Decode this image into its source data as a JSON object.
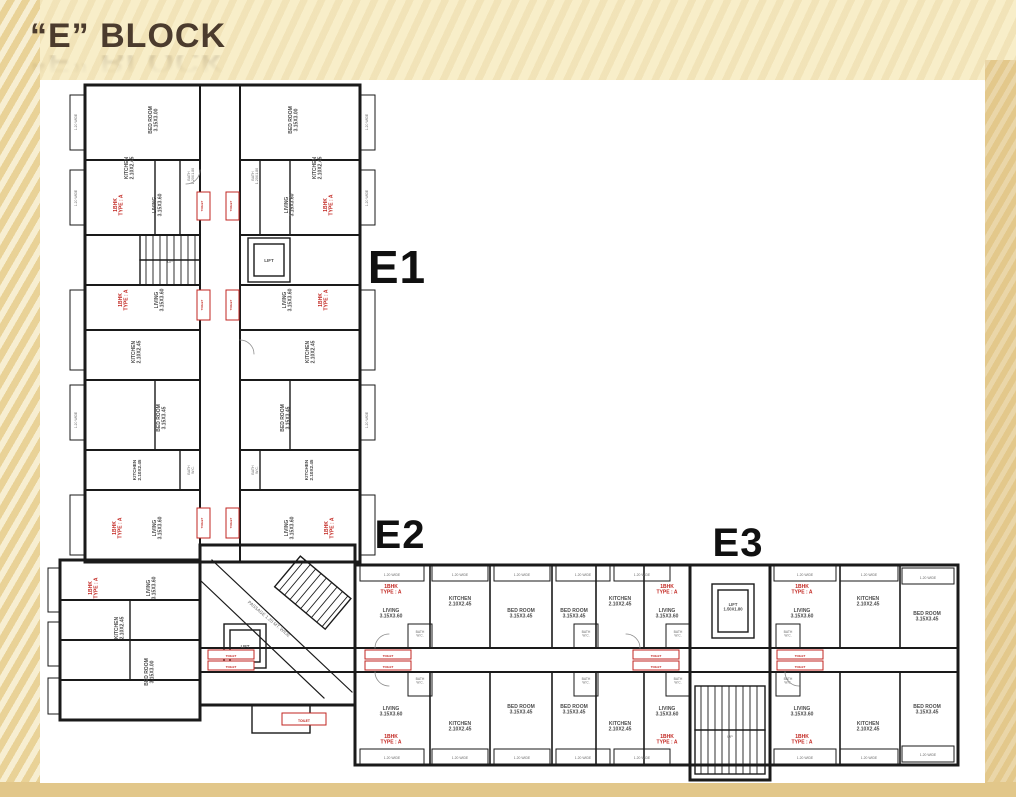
{
  "slide": {
    "title": "“E” BLOCK"
  },
  "colors": {
    "background": "#f8eec9",
    "side_band": "#e3c88b",
    "title": "#4b3b2d",
    "walls": "#1a1a1a",
    "flat_type_red": "#c22620",
    "plan_background": "#ffffff"
  },
  "plan": {
    "labels": [
      {
        "t": "E1",
        "x": 357,
        "y": 203,
        "s": 46,
        "c": "big"
      },
      {
        "t": "E2",
        "x": 360,
        "y": 468,
        "s": 40,
        "c": "big"
      },
      {
        "t": "E3",
        "x": 698,
        "y": 476,
        "s": 40,
        "c": "big"
      },
      {
        "t": "BED ROOM\n3.15X3.00",
        "x": 112,
        "y": 40,
        "r": -90,
        "s": 5,
        "c": "room"
      },
      {
        "t": "BED ROOM\n3.15X3.00",
        "x": 252,
        "y": 40,
        "r": -90,
        "s": 5,
        "c": "room"
      },
      {
        "t": "KITCHEN\n2.10X2.45",
        "x": 88,
        "y": 88,
        "r": -90,
        "s": 5,
        "c": "room"
      },
      {
        "t": "KITCHEN\n2.10X2.45",
        "x": 276,
        "y": 88,
        "r": -90,
        "s": 5,
        "c": "room"
      },
      {
        "t": "1BHK\nTYPE : A",
        "x": 77,
        "y": 125,
        "r": -90,
        "s": 5,
        "c": "red"
      },
      {
        "t": "1BHK\nTYPE : A",
        "x": 287,
        "y": 125,
        "r": -90,
        "s": 5,
        "c": "red"
      },
      {
        "t": "LIVING\n3.15X3.60",
        "x": 116,
        "y": 125,
        "r": -90,
        "s": 5,
        "c": "room"
      },
      {
        "t": "LIVING\n3.15X3.60",
        "x": 248,
        "y": 125,
        "r": -90,
        "s": 5,
        "c": "room"
      },
      {
        "t": "BATH\n1.20X1.80",
        "x": 150,
        "y": 96,
        "r": -90,
        "s": 3.6,
        "c": "tiny"
      },
      {
        "t": "BATH\n1.20X1.80",
        "x": 214,
        "y": 96,
        "r": -90,
        "s": 3.6,
        "c": "tiny"
      },
      {
        "t": "TOILET",
        "x": 163,
        "y": 126,
        "r": -90,
        "s": 3,
        "c": "red"
      },
      {
        "t": "TOILET",
        "x": 192,
        "y": 126,
        "r": -90,
        "s": 3,
        "c": "red"
      },
      {
        "t": "LIFT",
        "x": 229,
        "y": 182,
        "s": 4.5,
        "c": "room"
      },
      {
        "t": "UP",
        "x": 130,
        "y": 183,
        "s": 4,
        "c": "tiny"
      },
      {
        "t": "1BHK\nTYPE : A",
        "x": 82,
        "y": 220,
        "r": -90,
        "s": 5,
        "c": "red"
      },
      {
        "t": "1BHK\nTYPE : A",
        "x": 282,
        "y": 220,
        "r": -90,
        "s": 5,
        "c": "red"
      },
      {
        "t": "LIVING\n3.15X3.60",
        "x": 118,
        "y": 220,
        "r": -90,
        "s": 5,
        "c": "room"
      },
      {
        "t": "LIVING\n3.15X3.60",
        "x": 246,
        "y": 220,
        "r": -90,
        "s": 5,
        "c": "room"
      },
      {
        "t": "TOILET",
        "x": 163,
        "y": 225,
        "r": -90,
        "s": 3,
        "c": "red"
      },
      {
        "t": "TOILET",
        "x": 192,
        "y": 225,
        "r": -90,
        "s": 3,
        "c": "red"
      },
      {
        "t": "KITCHEN\n2.10X2.45",
        "x": 95,
        "y": 272,
        "r": -90,
        "s": 5,
        "c": "room"
      },
      {
        "t": "KITCHEN\n2.10X2.45",
        "x": 269,
        "y": 272,
        "r": -90,
        "s": 5,
        "c": "room"
      },
      {
        "t": "BED ROOM\n3.15X3.45",
        "x": 120,
        "y": 338,
        "r": -90,
        "s": 5,
        "c": "room"
      },
      {
        "t": "BED ROOM\n3.15X3.45",
        "x": 244,
        "y": 338,
        "r": -90,
        "s": 5,
        "c": "room"
      },
      {
        "t": "BATH\nW.C.",
        "x": 150,
        "y": 390,
        "r": -90,
        "s": 3.6,
        "c": "tiny"
      },
      {
        "t": "BATH\nW.C.",
        "x": 214,
        "y": 390,
        "r": -90,
        "s": 3.6,
        "c": "tiny"
      },
      {
        "t": "KITCHEN\n2.10X2.45",
        "x": 96,
        "y": 390,
        "r": -90,
        "s": 4.6,
        "c": "room"
      },
      {
        "t": "KITCHEN\n2.10X2.45",
        "x": 268,
        "y": 390,
        "r": -90,
        "s": 4.6,
        "c": "room"
      },
      {
        "t": "1BHK\nTYPE : A",
        "x": 76,
        "y": 448,
        "r": -90,
        "s": 5,
        "c": "red"
      },
      {
        "t": "1BHK\nTYPE : A",
        "x": 288,
        "y": 448,
        "r": -90,
        "s": 5,
        "c": "red"
      },
      {
        "t": "LIVING\n3.15X3.60",
        "x": 116,
        "y": 448,
        "r": -90,
        "s": 5,
        "c": "room"
      },
      {
        "t": "LIVING\n3.15X3.60",
        "x": 248,
        "y": 448,
        "r": -90,
        "s": 5,
        "c": "room"
      },
      {
        "t": "TOILET",
        "x": 163,
        "y": 443,
        "r": -90,
        "s": 3,
        "c": "red"
      },
      {
        "t": "TOILET",
        "x": 192,
        "y": 443,
        "r": -90,
        "s": 3,
        "c": "red"
      },
      {
        "t": "1.20 WIDE",
        "x": 37,
        "y": 42,
        "r": -90,
        "s": 3.4,
        "c": "tiny"
      },
      {
        "t": "1.20 WIDE",
        "x": 37,
        "y": 118,
        "r": -90,
        "s": 3.4,
        "c": "tiny"
      },
      {
        "t": "1.20 WIDE",
        "x": 37,
        "y": 340,
        "r": -90,
        "s": 3.4,
        "c": "tiny"
      },
      {
        "t": "1.20 WIDE",
        "x": 328,
        "y": 42,
        "r": -90,
        "s": 3.4,
        "c": "tiny"
      },
      {
        "t": "1.20 WIDE",
        "x": 328,
        "y": 118,
        "r": -90,
        "s": 3.4,
        "c": "tiny"
      },
      {
        "t": "1.20 WIDE",
        "x": 328,
        "y": 340,
        "r": -90,
        "s": 3.4,
        "c": "tiny"
      },
      {
        "t": "1BHK\nTYPE : A",
        "x": 52,
        "y": 508,
        "r": -90,
        "s": 5,
        "c": "red"
      },
      {
        "t": "LIVING\n3.15X3.60",
        "x": 110,
        "y": 508,
        "r": -90,
        "s": 5,
        "c": "room"
      },
      {
        "t": "KITCHEN\n2.10X2.45",
        "x": 78,
        "y": 548,
        "r": -90,
        "s": 5,
        "c": "room"
      },
      {
        "t": "BED ROOM\n3.15X3.00",
        "x": 108,
        "y": 592,
        "r": -90,
        "s": 5,
        "c": "room"
      },
      {
        "t": "PASSAGE 1.20 MT. WIDE",
        "x": 228,
        "y": 540,
        "r": 40,
        "s": 4.6,
        "c": "tiny"
      },
      {
        "t": "LIFT",
        "x": 205,
        "y": 568,
        "s": 4.2,
        "c": "room"
      },
      {
        "t": "TOILET",
        "x": 264,
        "y": 642,
        "s": 3.4,
        "c": "red"
      },
      {
        "t": "1BHK\nTYPE : A",
        "x": 351,
        "y": 508,
        "s": 5,
        "c": "red"
      },
      {
        "t": "LIVING\n3.15X3.60",
        "x": 351,
        "y": 532,
        "s": 5,
        "c": "room"
      },
      {
        "t": "KITCHEN\n2.10X2.45",
        "x": 420,
        "y": 520,
        "s": 5,
        "c": "room"
      },
      {
        "t": "BED ROOM\n3.15X3.45",
        "x": 481,
        "y": 532,
        "s": 5,
        "c": "room"
      },
      {
        "t": "BED ROOM\n3.15X3.45",
        "x": 534,
        "y": 532,
        "s": 5,
        "c": "room"
      },
      {
        "t": "KITCHEN\n2.10X2.45",
        "x": 580,
        "y": 520,
        "s": 5,
        "c": "room"
      },
      {
        "t": "LIVING\n3.15X3.60",
        "x": 627,
        "y": 532,
        "s": 5,
        "c": "room"
      },
      {
        "t": "1BHK\nTYPE : A",
        "x": 627,
        "y": 508,
        "s": 5,
        "c": "red"
      },
      {
        "t": "LIVING\n3.15X3.60",
        "x": 351,
        "y": 630,
        "s": 5,
        "c": "room"
      },
      {
        "t": "1BHK\nTYPE : A",
        "x": 351,
        "y": 658,
        "s": 5,
        "c": "red"
      },
      {
        "t": "KITCHEN\n2.10X2.45",
        "x": 420,
        "y": 645,
        "s": 5,
        "c": "room"
      },
      {
        "t": "BED ROOM\n3.15X3.45",
        "x": 481,
        "y": 628,
        "s": 5,
        "c": "room"
      },
      {
        "t": "BED ROOM\n3.15X3.45",
        "x": 534,
        "y": 628,
        "s": 5,
        "c": "room"
      },
      {
        "t": "KITCHEN\n2.10X2.45",
        "x": 580,
        "y": 645,
        "s": 5,
        "c": "room"
      },
      {
        "t": "LIVING\n3.15X3.60",
        "x": 627,
        "y": 630,
        "s": 5,
        "c": "room"
      },
      {
        "t": "1BHK\nTYPE : A",
        "x": 627,
        "y": 658,
        "s": 5,
        "c": "red"
      },
      {
        "t": "LIFT\n1.50X1.80",
        "x": 693,
        "y": 526,
        "s": 4.2,
        "c": "room"
      },
      {
        "t": "UP",
        "x": 690,
        "y": 658,
        "s": 4,
        "c": "tiny"
      },
      {
        "t": "1BHK\nTYPE : A",
        "x": 762,
        "y": 508,
        "s": 5,
        "c": "red"
      },
      {
        "t": "LIVING\n3.15X3.60",
        "x": 762,
        "y": 532,
        "s": 5,
        "c": "room"
      },
      {
        "t": "KITCHEN\n2.10X2.45",
        "x": 828,
        "y": 520,
        "s": 5,
        "c": "room"
      },
      {
        "t": "BED ROOM\n3.15X3.45",
        "x": 887,
        "y": 535,
        "s": 5,
        "c": "room"
      },
      {
        "t": "LIVING\n3.15X3.60",
        "x": 762,
        "y": 630,
        "s": 5,
        "c": "room"
      },
      {
        "t": "1BHK\nTYPE : A",
        "x": 762,
        "y": 658,
        "s": 5,
        "c": "red"
      },
      {
        "t": "KITCHEN\n2.10X2.45",
        "x": 828,
        "y": 645,
        "s": 5,
        "c": "room"
      },
      {
        "t": "BED ROOM\n3.15X3.45",
        "x": 887,
        "y": 628,
        "s": 5,
        "c": "room"
      },
      {
        "t": "TOILET",
        "x": 191,
        "y": 577,
        "s": 3,
        "c": "red"
      },
      {
        "t": "TOILET",
        "x": 191,
        "y": 588,
        "s": 3,
        "c": "red"
      },
      {
        "t": "TOILET",
        "x": 348,
        "y": 577,
        "s": 3,
        "c": "red"
      },
      {
        "t": "TOILET",
        "x": 348,
        "y": 588,
        "s": 3,
        "c": "red"
      },
      {
        "t": "TOILET",
        "x": 616,
        "y": 577,
        "s": 3,
        "c": "red"
      },
      {
        "t": "TOILET",
        "x": 616,
        "y": 588,
        "s": 3,
        "c": "red"
      },
      {
        "t": "TOILET",
        "x": 760,
        "y": 577,
        "s": 3,
        "c": "red"
      },
      {
        "t": "TOILET",
        "x": 760,
        "y": 588,
        "s": 3,
        "c": "red"
      },
      {
        "t": "BATH\nW.C.",
        "x": 380,
        "y": 553,
        "s": 3.4,
        "c": "tiny"
      },
      {
        "t": "BATH\nW.C.",
        "x": 380,
        "y": 600,
        "s": 3.4,
        "c": "tiny"
      },
      {
        "t": "BATH\nW.C.",
        "x": 546,
        "y": 553,
        "s": 3.4,
        "c": "tiny"
      },
      {
        "t": "BATH\nW.C.",
        "x": 546,
        "y": 600,
        "s": 3.4,
        "c": "tiny"
      },
      {
        "t": "BATH\nW.C.",
        "x": 638,
        "y": 553,
        "s": 3.4,
        "c": "tiny"
      },
      {
        "t": "BATH\nW.C.",
        "x": 638,
        "y": 600,
        "s": 3.4,
        "c": "tiny"
      },
      {
        "t": "BATH\nW.C.",
        "x": 748,
        "y": 553,
        "s": 3.4,
        "c": "tiny"
      },
      {
        "t": "BATH\nW.C.",
        "x": 748,
        "y": 600,
        "s": 3.4,
        "c": "tiny"
      },
      {
        "t": "1.20 WIDE",
        "x": 352,
        "y": 496,
        "s": 3.4,
        "c": "tiny"
      },
      {
        "t": "1.20 WIDE",
        "x": 420,
        "y": 496,
        "s": 3.4,
        "c": "tiny"
      },
      {
        "t": "1.20 WIDE",
        "x": 482,
        "y": 496,
        "s": 3.4,
        "c": "tiny"
      },
      {
        "t": "1.20 WIDE",
        "x": 543,
        "y": 496,
        "s": 3.4,
        "c": "tiny"
      },
      {
        "t": "1.20 WIDE",
        "x": 602,
        "y": 496,
        "s": 3.4,
        "c": "tiny"
      },
      {
        "t": "1.20 WIDE",
        "x": 765,
        "y": 496,
        "s": 3.4,
        "c": "tiny"
      },
      {
        "t": "1.20 WIDE",
        "x": 829,
        "y": 496,
        "s": 3.4,
        "c": "tiny"
      },
      {
        "t": "1.20 WIDE",
        "x": 888,
        "y": 499,
        "s": 3.4,
        "c": "tiny"
      },
      {
        "t": "1.20 WIDE",
        "x": 352,
        "y": 679,
        "s": 3.4,
        "c": "tiny"
      },
      {
        "t": "1.20 WIDE",
        "x": 420,
        "y": 679,
        "s": 3.4,
        "c": "tiny"
      },
      {
        "t": "1.20 WIDE",
        "x": 482,
        "y": 679,
        "s": 3.4,
        "c": "tiny"
      },
      {
        "t": "1.20 WIDE",
        "x": 543,
        "y": 679,
        "s": 3.4,
        "c": "tiny"
      },
      {
        "t": "1.20 WIDE",
        "x": 602,
        "y": 679,
        "s": 3.4,
        "c": "tiny"
      },
      {
        "t": "1.20 WIDE",
        "x": 765,
        "y": 679,
        "s": 3.4,
        "c": "tiny"
      },
      {
        "t": "1.20 WIDE",
        "x": 829,
        "y": 679,
        "s": 3.4,
        "c": "tiny"
      },
      {
        "t": "1.20 WIDE",
        "x": 888,
        "y": 676,
        "s": 3.4,
        "c": "tiny"
      }
    ]
  }
}
